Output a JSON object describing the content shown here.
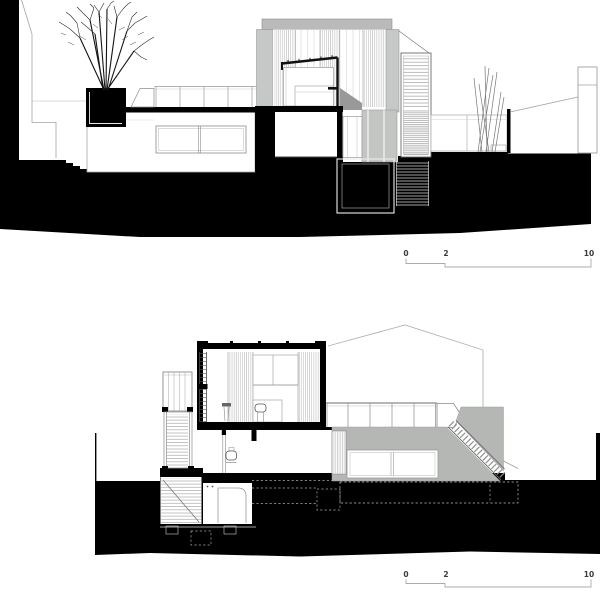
{
  "page": {
    "width": 600,
    "height": 598,
    "background": "#ffffff",
    "description": "Two architectural cross-section drawings stacked vertically, each with a graphic scale bar (0–2–10 m)"
  },
  "sections": {
    "top": {
      "name": "upper-cross-section"
    },
    "bottom": {
      "name": "lower-cross-section"
    }
  },
  "scalebar_top": {
    "label_0": "0",
    "label_2": "2",
    "label_10": "10"
  },
  "scalebar_bottom": {
    "label_0": "0",
    "label_2": "2",
    "label_10": "10"
  },
  "colors": {
    "poche": "#000000",
    "roof_gray": "#b9bab9",
    "wall_gray": "#c6c8c7",
    "mid_gray": "#c3c5c3",
    "volume_gray": "#b5b7b4",
    "line_gray": "#999999",
    "scale_line": "#ababab",
    "scale_text": "#3a3a3a"
  }
}
